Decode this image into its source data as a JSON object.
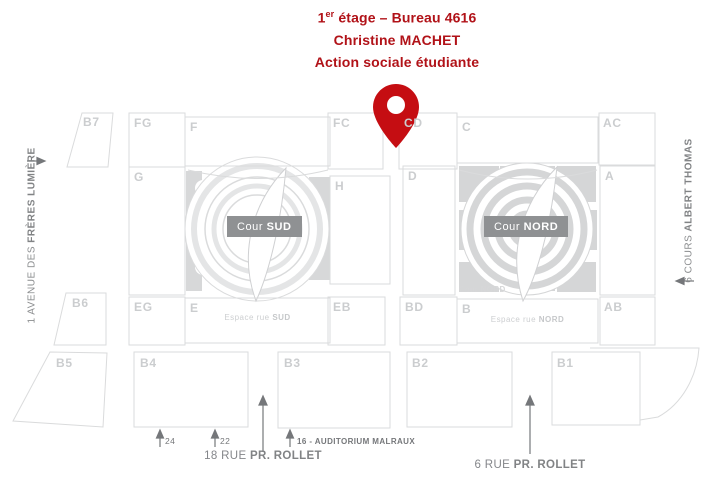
{
  "header": {
    "line1_num": "1",
    "line1_sup": "er",
    "line1_rest": " étage – Bureau 4616",
    "line2": "Christine MACHET",
    "line3": "Action sociale étudiante",
    "text_color": "#b11218",
    "pin_color": "#c50d12"
  },
  "buildings": {
    "b7": "B7",
    "fg": "FG",
    "f": "F",
    "fc": "FC",
    "cd": "CD",
    "c": "C",
    "ac": "AC",
    "g": "G",
    "h": "H",
    "d": "D",
    "a": "A",
    "b6": "B6",
    "eg": "EG",
    "e": "E",
    "eb": "EB",
    "bd": "BD",
    "b": "B",
    "ab": "AB",
    "b5": "B5",
    "b4": "B4",
    "b3": "B3",
    "b2": "B2",
    "b1": "B1"
  },
  "courtyards": {
    "sud_prefix": "Cour ",
    "sud_bold": "SUD",
    "nord_prefix": "Cour ",
    "nord_bold": "NORD",
    "nord_small_prefix": "Cour ",
    "nord_small_bold": "NORD",
    "label_bg": "#8f9193"
  },
  "espaces": {
    "sud_prefix": "Espace rue ",
    "sud_bold": "SUD",
    "nord_prefix": "Espace rue ",
    "nord_bold": "NORD"
  },
  "streets": {
    "left_prefix": "1 AVENUE DES ",
    "left_bold": "FRÈRES LUMIÈRE",
    "right_prefix": "6 COURS ",
    "right_bold": "ALBERT THOMAS",
    "bottom_left_prefix": "18 RUE ",
    "bottom_left_bold": "PR. ROLLET",
    "bottom_right_prefix": "6 RUE ",
    "bottom_right_bold": "PR. ROLLET"
  },
  "entrances": {
    "n24": "24",
    "n22": "22",
    "n16": "16 - AUDITORIUM MALRAUX"
  },
  "map_colors": {
    "outline": "#dadbdc",
    "label_gray": "#cbcdcf",
    "fill_gray": "#d6d7d8"
  }
}
